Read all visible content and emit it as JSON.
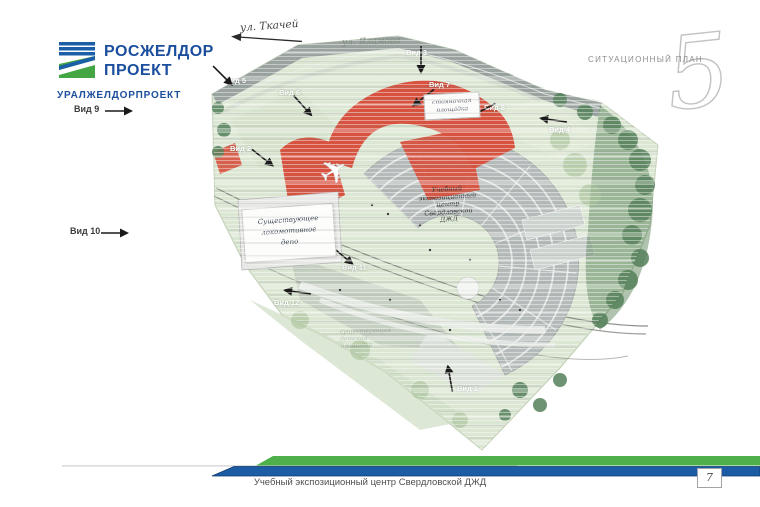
{
  "logo": {
    "line1": "РОСЖЕЛДОР",
    "line2": "ПРОЕКТ",
    "org": "УРАЛЖЕЛДОРПРОЕКТ",
    "brand_blue": "#1b5fa8",
    "brand_green": "#43a643"
  },
  "sheet": {
    "label": "СИТУАЦИОННЫЙ ПЛАН",
    "numeral": "5"
  },
  "streets": {
    "tkachey": "ул. Ткачей",
    "yalamova": "ул. Яламова"
  },
  "views": [
    {
      "label": "Вид 1"
    },
    {
      "label": "Вид 2"
    },
    {
      "label": "Вид 3"
    },
    {
      "label": "Вид 4"
    },
    {
      "label": "Вид 5"
    },
    {
      "label": "Вид 6"
    },
    {
      "label": "Вид 7"
    },
    {
      "label": "Вид 8"
    },
    {
      "label": "Вид 9"
    },
    {
      "label": "Вид 10"
    },
    {
      "label": "Вид 11"
    },
    {
      "label": "Вид 12"
    }
  ],
  "annotations": {
    "parking": {
      "lines": [
        "стояночная",
        "площадка"
      ]
    },
    "depot": {
      "lines": [
        "Существующее",
        "локомотивное",
        "депо"
      ]
    },
    "center": {
      "lines": [
        "Учебный",
        "экспозиционный",
        "центр",
        "Свердловской",
        "ДЖД"
      ]
    },
    "playground": {
      "lines": [
        "существующая",
        "детская",
        "площадка"
      ]
    }
  },
  "footer": {
    "title": "Учебный экспозиционный центр Свердловской ДЖД",
    "page": "7"
  },
  "colors": {
    "plan_green": "#dbe6d3",
    "road_gray": "#9aa3a0",
    "roof_red": "#d7523f",
    "fan_gray": "#b5bbba",
    "tree_green": "#55815a",
    "stripe_green": "#4db04a",
    "stripe_blue": "#1c5ca4"
  }
}
